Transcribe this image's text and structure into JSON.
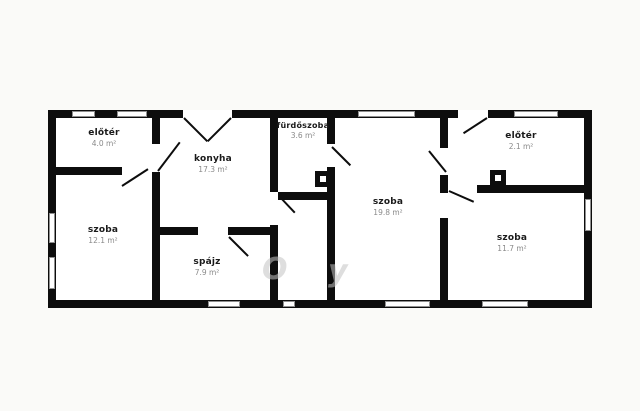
{
  "plan": {
    "background_color": "#fafaf8",
    "wall_color": "#0d0d0d",
    "floor_color": "#ffffff"
  },
  "rooms": [
    {
      "name": "előtér",
      "area": "4.0 m²"
    },
    {
      "name": "konyha",
      "area": "17.3 m²"
    },
    {
      "name": "fürdőszoba",
      "area": "3.6 m²"
    },
    {
      "name": "szoba",
      "area": "19.8 m²"
    },
    {
      "name": "előtér",
      "area": "2.1 m²"
    },
    {
      "name": "szoba",
      "area": "11.7 m²"
    },
    {
      "name": "szoba",
      "area": "12.1 m²"
    },
    {
      "name": "spájz",
      "area": "7.9 m²"
    }
  ],
  "watermark": {
    "fragments": [
      "O",
      "y"
    ]
  }
}
